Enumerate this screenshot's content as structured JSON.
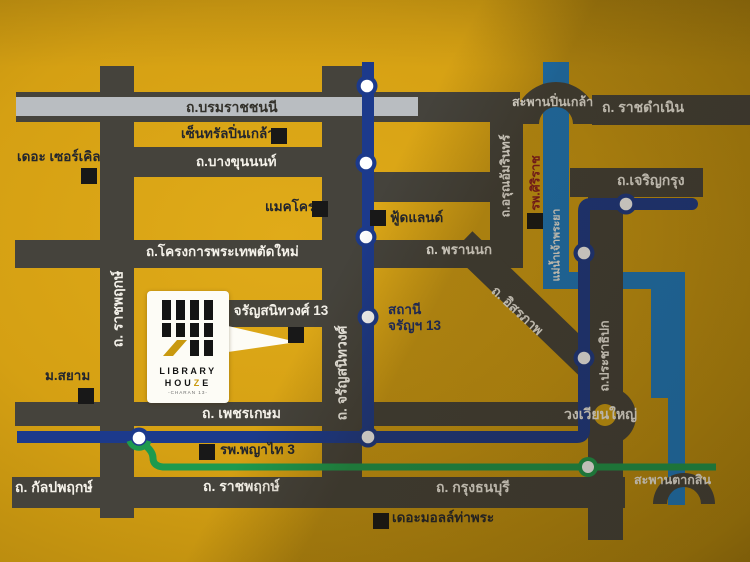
{
  "colors": {
    "background": "#d5a013",
    "road": "#45433c",
    "road_stripe": "#b9bdc1",
    "river_blue": "#1d7cc4",
    "mrt_navy": "#1c3a8c",
    "line_green": "#1d9a4e",
    "marker_black": "#181818",
    "logo_gold": "#c9990f",
    "hospital_red": "#8a1c20"
  },
  "roads": {
    "borommaratchachonnani": "ถ.บรมราชชนนี",
    "bang_khun_non": "ถ.บางขุนนนท์",
    "phra_thep_new_project": "ถ.โครงการพระเทพตัดใหม่",
    "phran_nok": "ถ. พรานนก",
    "arun_amarin": "ถ.อรุณอัมรินทร์",
    "ratchadamnoen": "ถ. ราชดำเนิน",
    "charoen_krung": "ถ.เจริญกรุง",
    "itsaraphap": "ถ. อิสรภาพ",
    "prachathipok": "ถ.ประชาธิปก",
    "charan_sanitwong": "ถ. จรัญสนิทวงศ์",
    "ratchaphruek_vertical": "ถ. ราชพฤกษ์",
    "phetkasem": "ถ. เพชรเกษม",
    "kanlapaphruek": "ถ. กัลปพฤกษ์",
    "ratchaphruek_horizontal": "ถ. ราชพฤกษ์",
    "krung_thonburi": "ถ. กรุงธนบุรี",
    "soi_charan_13": "ช. จรัญสนิทวงศ์ 13"
  },
  "places": {
    "saphan_pinklao": "สะพานปิ่นเกล้า",
    "saphan_taksin": "สะพานตากสิน",
    "wongwian_yai": "วงเวียนใหญ่",
    "chao_phraya_river": "แม่น้ำเจ้าพระยา",
    "central_pinklao": "เซ็นทรัลปิ่นเกล้า",
    "the_circle": "เดอะ เซอร์เคิล",
    "makro": "แมคโคร",
    "foodland": "ฟู้ดแลนด์",
    "siriraj_hospital": "รพ.ศิริราช",
    "m_siam": "ม.สยาม",
    "phyathai_3_hospital": "รพ.พญาไท 3",
    "the_mall_tha_phra": "เดอะมอลล์ท่าพระ"
  },
  "transit": {
    "station_charan13_line1": "สถานี",
    "station_charan13_line2": "จรัญฯ 13"
  },
  "logo": {
    "library": "LIBRARY",
    "hou": "HOU",
    "z": "Z",
    "e": "E",
    "charan": "-CHARAN 13-"
  }
}
